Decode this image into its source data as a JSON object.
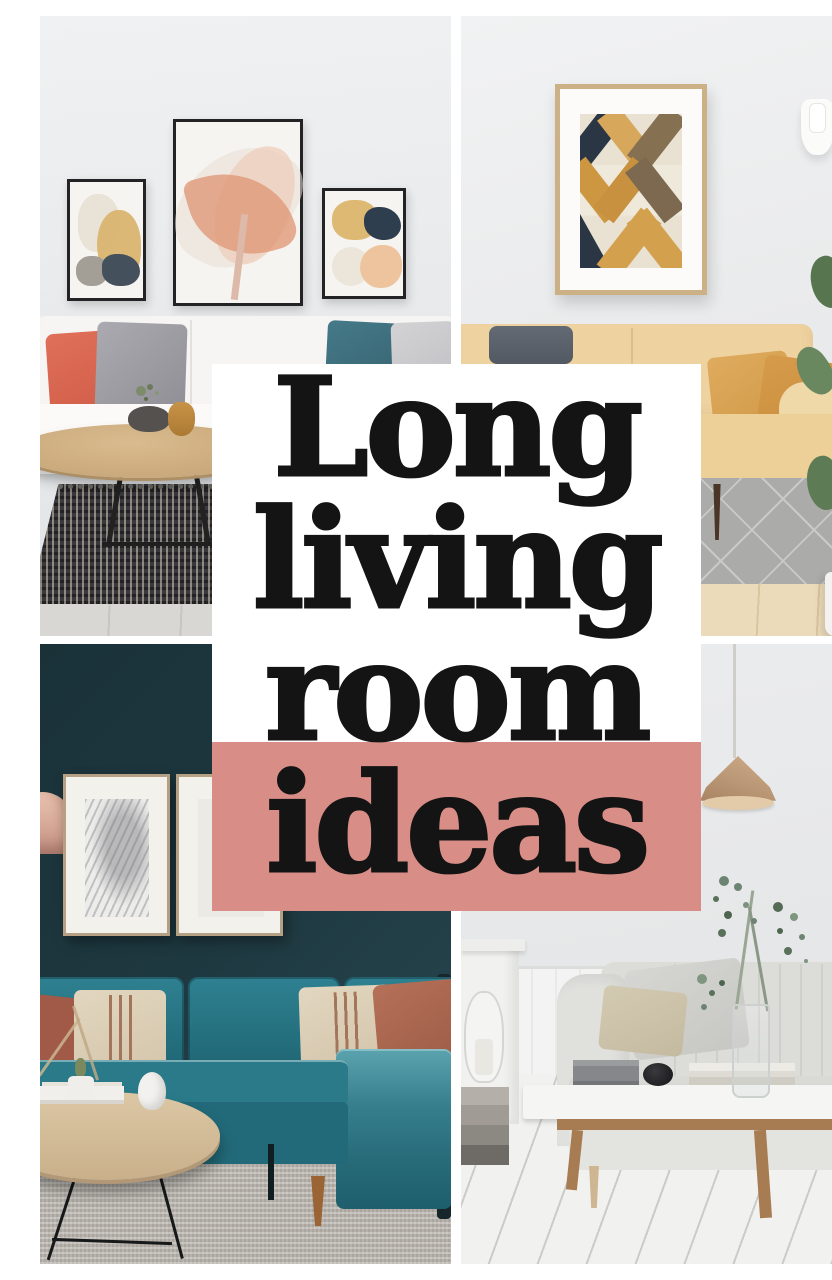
{
  "pin": {
    "title": "Long living room ideas",
    "title_lines": [
      "Long",
      "living",
      "room",
      "ideas"
    ]
  },
  "style": {
    "overlay_card_bg": "#ffffff",
    "overlay_accent_bg": "#d88e87",
    "overlay_text_color": "#141414",
    "divider_color": "#ffffff",
    "palette": {
      "dark_teal_wall": "#1c333a",
      "teal_sofa": "#2b7d8c",
      "yellow_sofa": "#ecd09c",
      "mustard_pillow": "#d8a254",
      "coral_pillow": "#d96751",
      "rust_pillow": "#ad6853",
      "wood": "#c9a97c",
      "light_wall": "#e9eaeb"
    }
  },
  "photos": [
    {
      "id": "top-left",
      "alt": "White living room with gallery wall of three abstract prints in black frames, white sofa with coral, grey and teal cushions, round wooden coffee table and dark woven rug"
    },
    {
      "id": "top-right",
      "alt": "Living room with framed geometric art, pale yellow leather sofa with mustard velvet cushions, grey diamond-pattern rug, wall sconce and fiddle-leaf fig plant"
    },
    {
      "id": "bottom-left",
      "alt": "Moody living room with dark teal wall, two wood-framed sketches, blush pendant lamp, teal velvet sectional with rust and striped cushions, round wood coffee table on grey rug"
    },
    {
      "id": "bottom-right",
      "alt": "Bright Scandinavian living room with grey channel-tufted sofa, white coffee table with books and speaker, eucalyptus stems in a glass vase, pendant lamp and white plank floor"
    }
  ]
}
